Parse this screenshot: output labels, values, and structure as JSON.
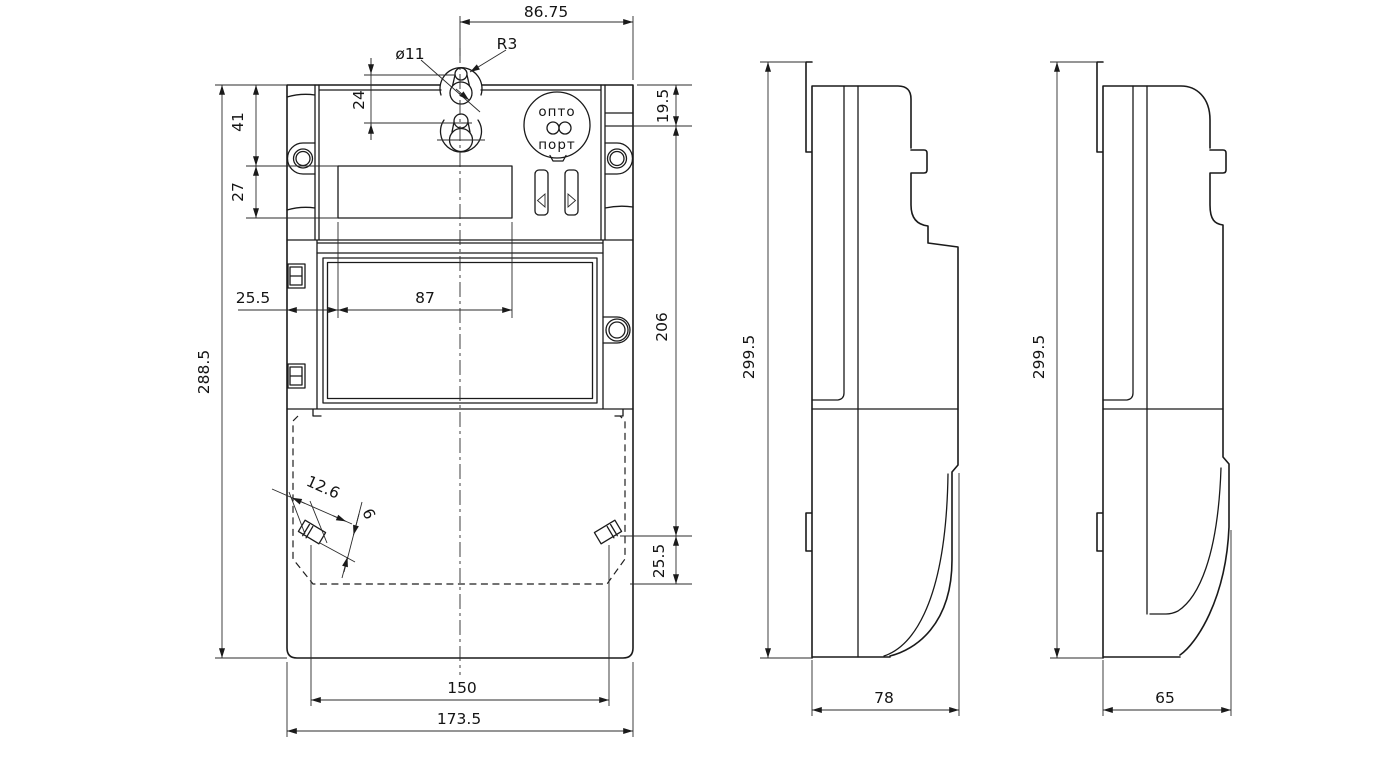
{
  "drawing": {
    "description": "Three-view dimensioned outline drawing of an electricity meter enclosure",
    "colors": {
      "background": "#ffffff",
      "line": "#1a1a1a"
    },
    "opto_port": {
      "line1": "опто",
      "line2": "порт"
    },
    "dims": {
      "top_width": "86.75",
      "hole_dia": "ø11",
      "hole_radius": "R3",
      "top_inset": "19.5",
      "hang_pitch": "24",
      "ear_offset": "41",
      "lcd_height": "27",
      "body_height": "288.5",
      "lcd_inset": "25.5",
      "lcd_width": "87",
      "face_height": "206",
      "screw_to_cover": "25.5",
      "screw_length": "12.6",
      "screw_dia": "6",
      "screw_pitch": "150",
      "overall_width": "173.5",
      "side_height": "299.5",
      "side_depth": "78",
      "side2_height": "299.5",
      "side2_depth": "65"
    }
  }
}
